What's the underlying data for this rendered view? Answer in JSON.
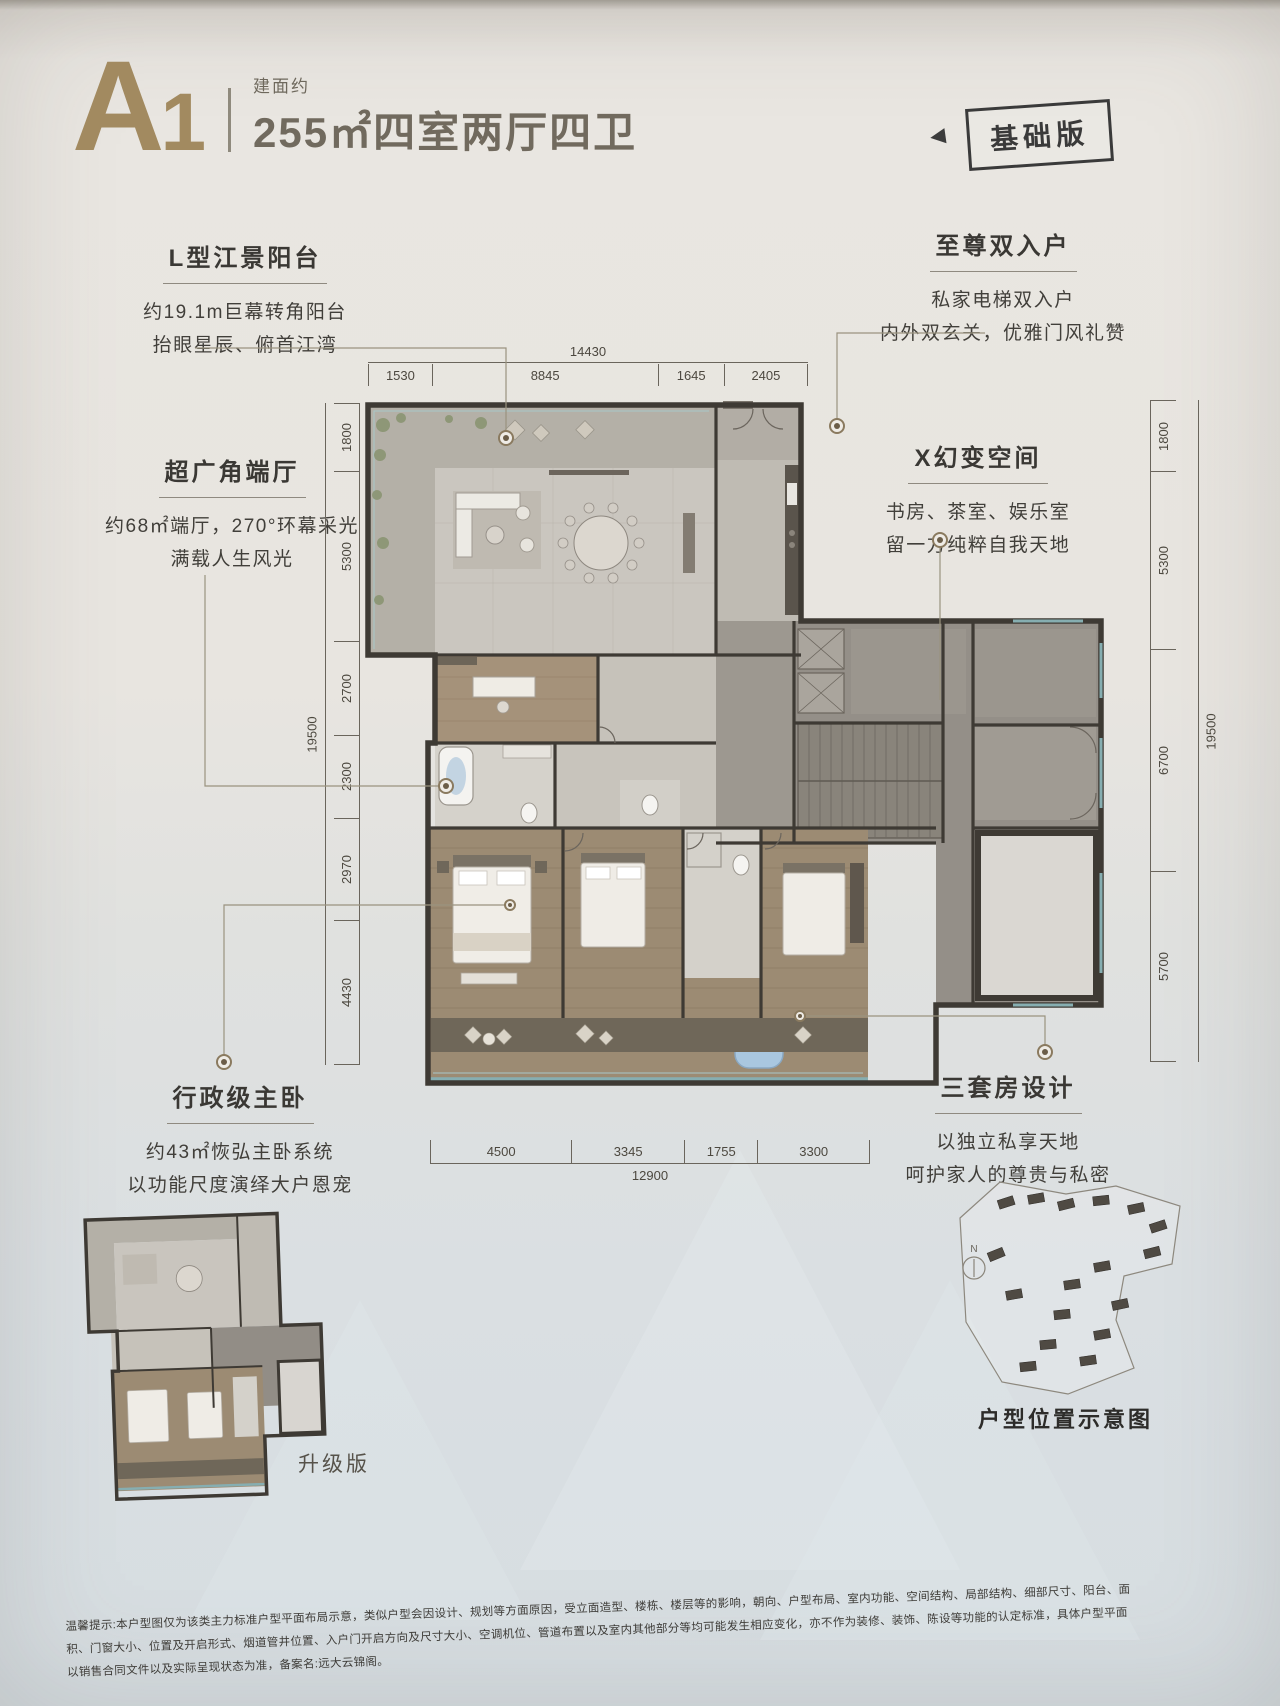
{
  "header": {
    "unit_code_letter": "A",
    "unit_code_number": "1",
    "area_prefix": "建面约",
    "area_spec": "255㎡四室两厅四卫",
    "version_badge": "基础版",
    "badge_arrow": "◀"
  },
  "callouts": {
    "balcony": {
      "title": "L型江景阳台",
      "line1": "约19.1m巨幕转角阳台",
      "line2": "抬眼星辰、俯首江湾"
    },
    "endhall": {
      "title": "超广角端厅",
      "line1": "约68㎡端厅，270°环幕采光",
      "line2": "满载人生风光"
    },
    "master": {
      "title": "行政级主卧",
      "line1": "约43㎡恢弘主卧系统",
      "line2": "以功能尺度演绎大户恩宠"
    },
    "entry": {
      "title": "至尊双入户",
      "line1": "私家电梯双入户",
      "line2": "内外双玄关，优雅门风礼赞"
    },
    "xspace": {
      "title": "X幻变空间",
      "line1": "书房、茶室、娱乐室",
      "line2": "留一方纯粹自我天地"
    },
    "suites": {
      "title": "三套房设计",
      "line1": "以独立私享天地",
      "line2": "呵护家人的尊贵与私密"
    }
  },
  "dimensions": {
    "top_total": "14430",
    "top_segments": [
      "1530",
      "8845",
      "1645",
      "2405"
    ],
    "bottom_total": "12900",
    "bottom_segments": [
      "4500",
      "3345",
      "1755",
      "3300"
    ],
    "left_total": "19500",
    "left_segments": [
      "1800",
      "5300",
      "2700",
      "2300",
      "2970",
      "4430"
    ],
    "right_total": "19500",
    "right_segments": [
      "1800",
      "5300",
      "6700",
      "5700"
    ]
  },
  "footer": {
    "upgrade_label": "升级版",
    "site_map_label": "户型位置示意图",
    "compass": "N",
    "disclaimer_line1": "温馨提示:本户型图仅为该类主力标准户型平面布局示意，类似户型会因设计、规划等方面原因，受立面造型、楼栋、楼层等的影响，朝向、户型布局、室内功能、空间结构、局部结构、细部尺寸、阳台、面",
    "disclaimer_line2": "积、门窗大小、位置及开启形式、烟道管井位置、入户门开启方向及尺寸大小、空调机位、管道布置以及室内其他部分等均可能发生相应变化，亦不作为装修、装饰、陈设等功能的认定标准，具体户型平面",
    "disclaimer_line3": "以销售合同文件以及实际呈现状态为准，备案名:远大云锦阁。"
  },
  "colors": {
    "brand_bronze": "#a28a60",
    "wall_dark": "#3e3a34",
    "glass_teal": "#86aeb1",
    "wood_floor": "#9c8b73",
    "tile_floor": "#cac6bf",
    "core_gray": "#948f88"
  }
}
